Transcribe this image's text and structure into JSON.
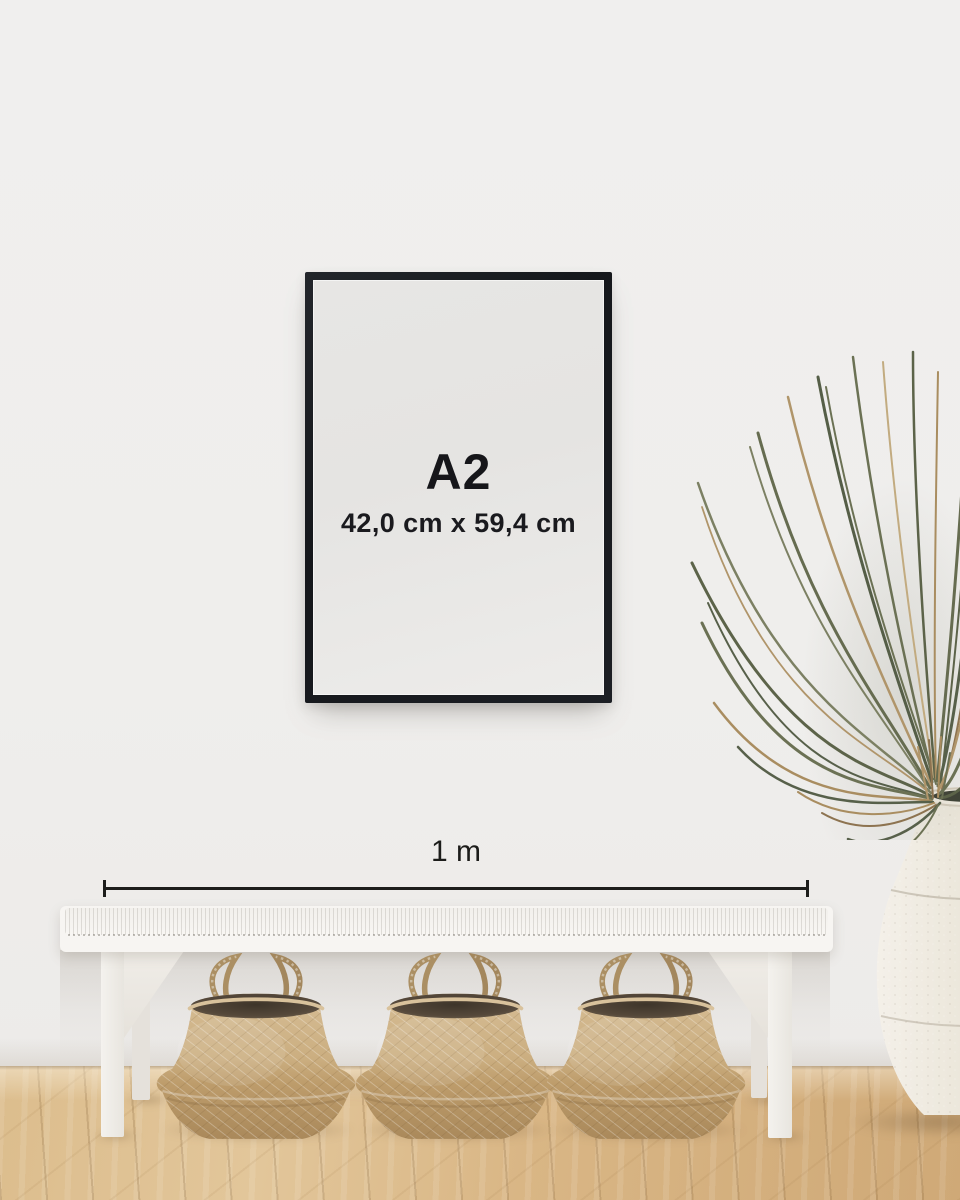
{
  "scene": {
    "poster": {
      "size_label": "A2",
      "dimensions_label": "42,0 cm x 59,4 cm"
    },
    "scale": {
      "label": "1 m"
    },
    "colors": {
      "wall": "#efeeec",
      "frame": "#17191d",
      "poster": "#e8e7e5",
      "text": "#16161a",
      "scale_line": "#1d1d1b",
      "bench": "#f6f4f1",
      "basket": "#c3a175",
      "basket_interior": "#4e4437",
      "floor": "#d8b584",
      "plant_green": "#5c6349",
      "plant_dried": "#a98d60",
      "vase": "#ece7dc"
    }
  }
}
